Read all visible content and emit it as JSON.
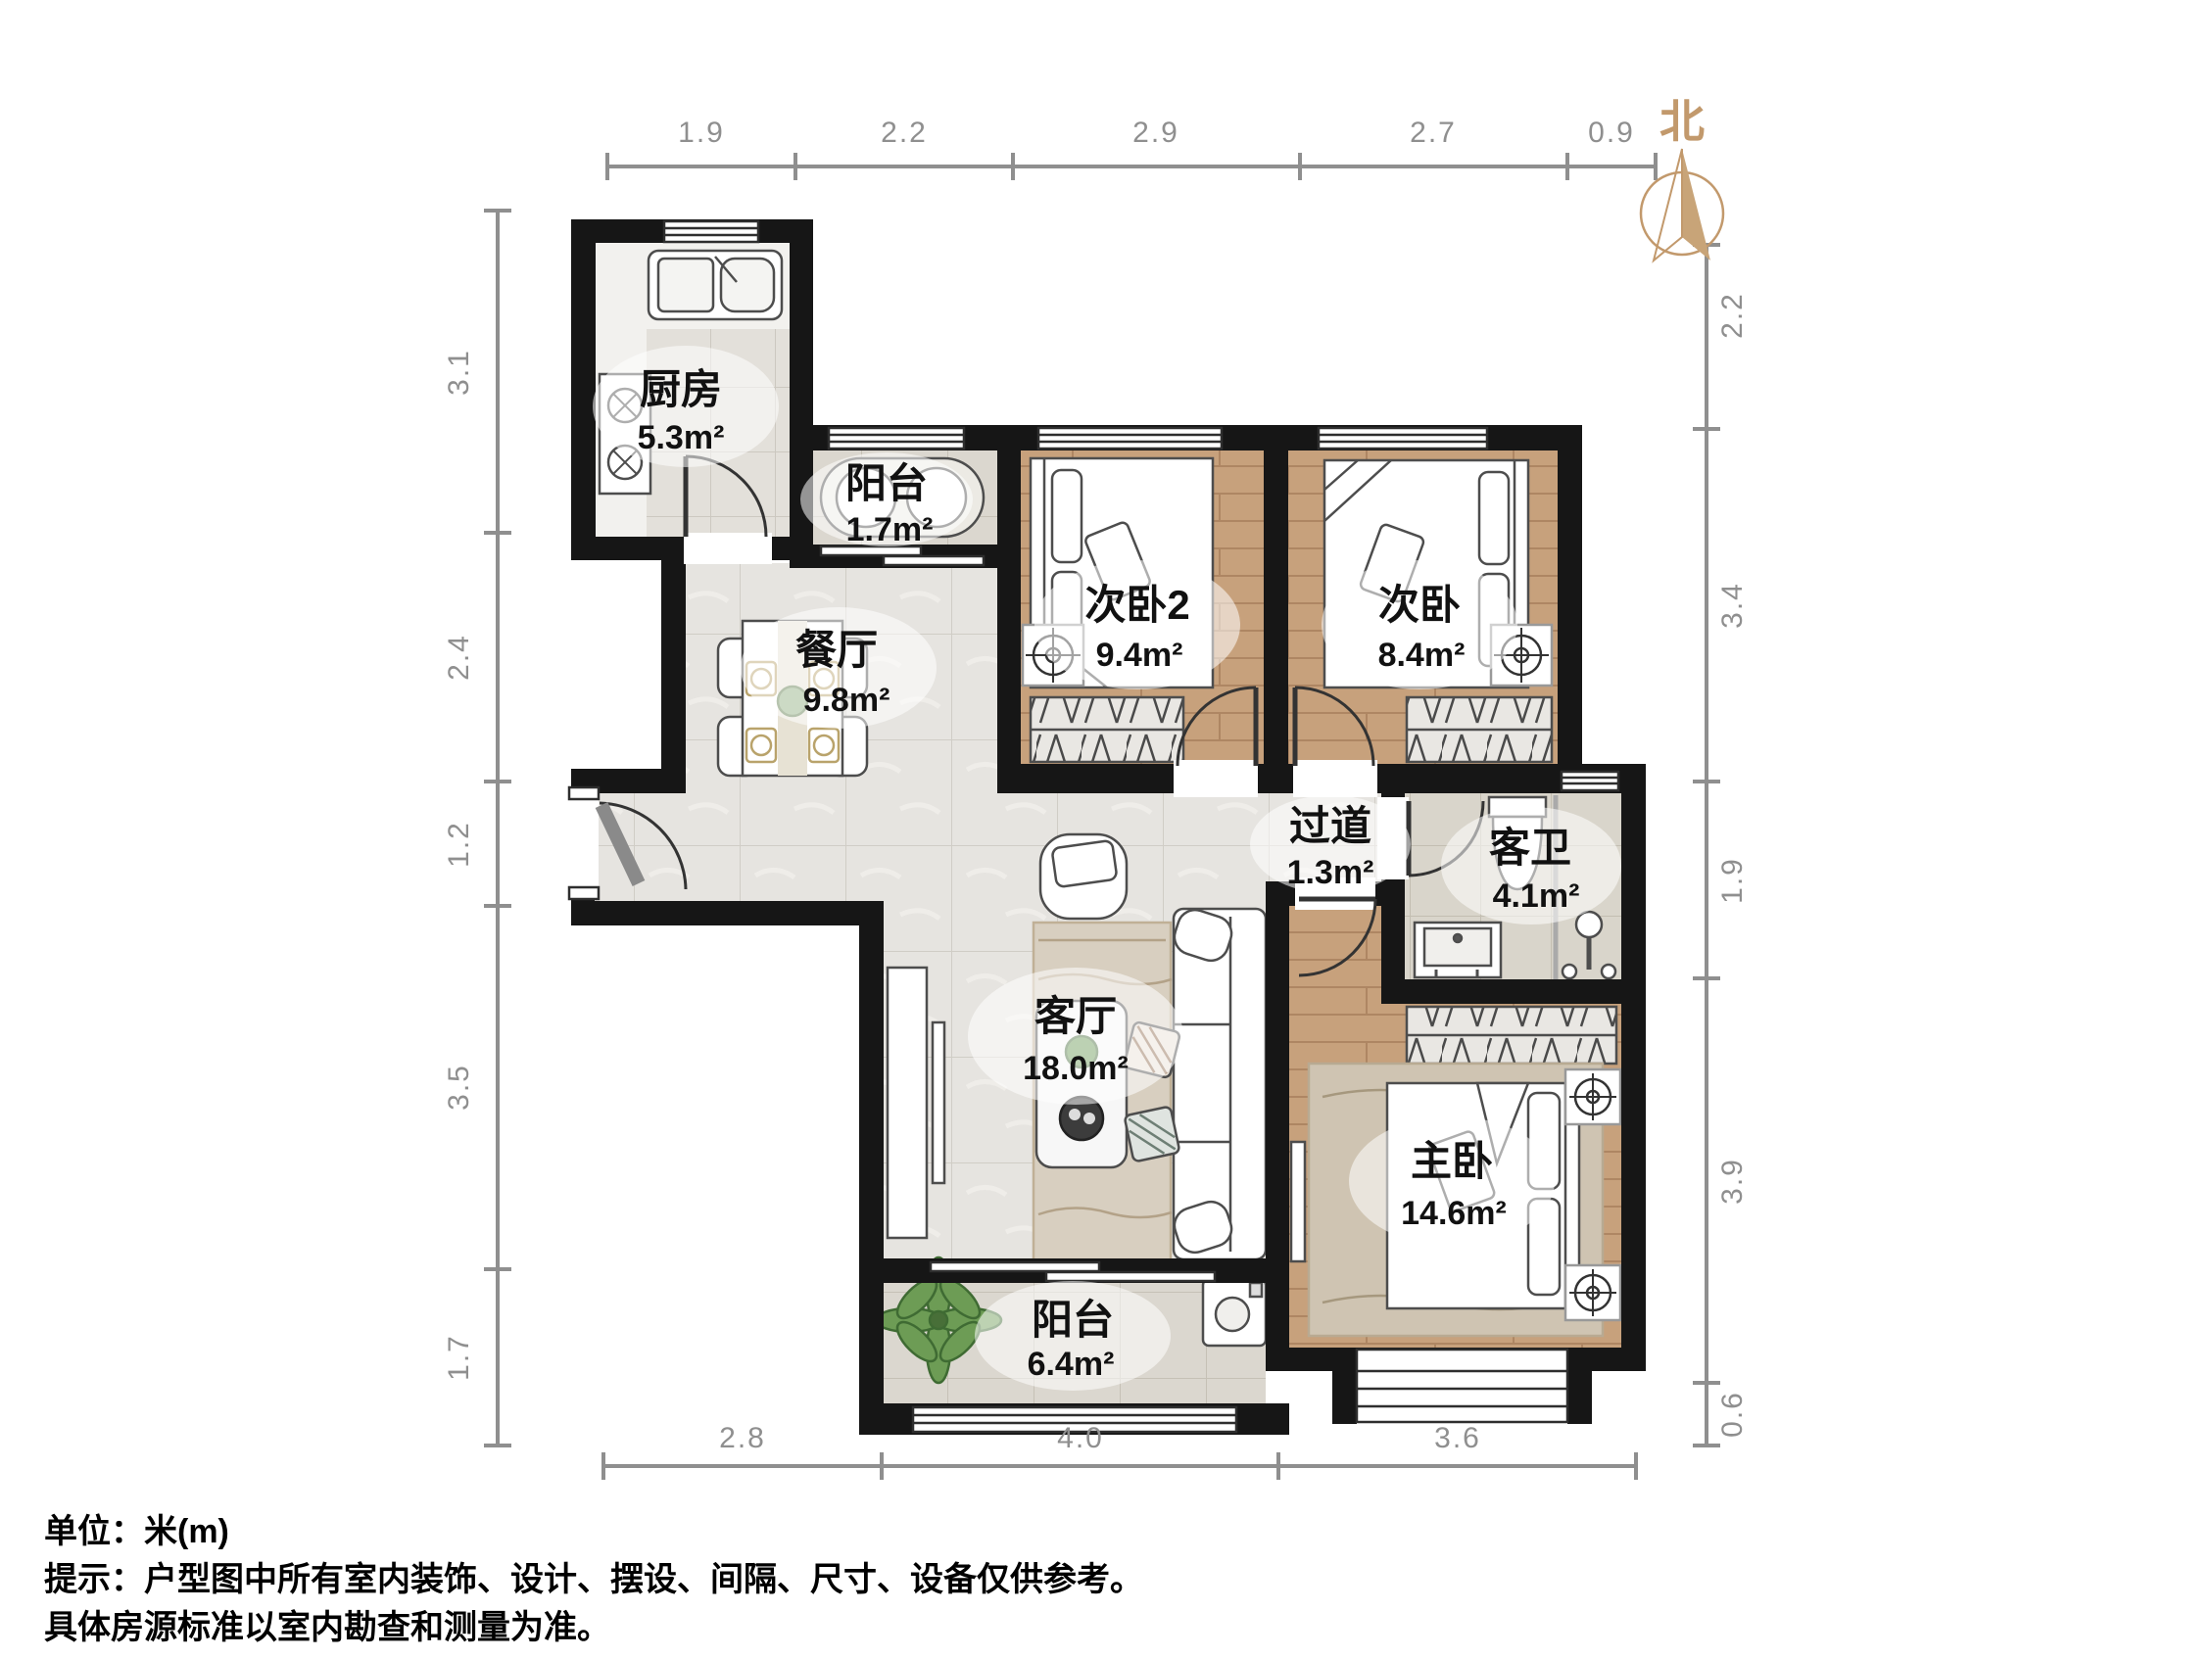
{
  "compass": {
    "label": "北"
  },
  "rooms": {
    "kitchen": {
      "name": "厨房",
      "area": "5.3m²"
    },
    "balcony_north": {
      "name": "阳台",
      "area": "1.7m²"
    },
    "bedroom2": {
      "name": "次卧2",
      "area": "9.4m²"
    },
    "bedroom": {
      "name": "次卧",
      "area": "8.4m²"
    },
    "dining": {
      "name": "餐厅",
      "area": "9.8m²"
    },
    "hallway": {
      "name": "过道",
      "area": "1.3m²"
    },
    "bathroom": {
      "name": "客卫",
      "area": "4.1m²"
    },
    "living": {
      "name": "客厅",
      "area": "18.0m²"
    },
    "master": {
      "name": "主卧",
      "area": "14.6m²"
    },
    "balcony_south": {
      "name": "阳台",
      "area": "6.4m²"
    }
  },
  "dimensions": {
    "top": [
      "1.9",
      "2.2",
      "2.9",
      "2.7",
      "0.9"
    ],
    "left": [
      "3.1",
      "2.4",
      "1.2",
      "3.5",
      "1.7"
    ],
    "right": [
      "2.2",
      "3.4",
      "1.9",
      "3.9",
      "0.6"
    ],
    "bottom": [
      "2.8",
      "4.0",
      "3.6"
    ]
  },
  "footer": {
    "line1": "单位：米(m)",
    "line2": "提示：户型图中所有室内装饰、设计、摆设、间隔、尺寸、设备仅供参考。",
    "line3": "具体房源标准以室内勘查和测量为准。"
  },
  "colors": {
    "wall": "#161616",
    "wood_floor": "#c7a17c",
    "tile_floor": "#e6e4e0",
    "compass": "#c2996c",
    "dimension": "#8f8f8f"
  }
}
